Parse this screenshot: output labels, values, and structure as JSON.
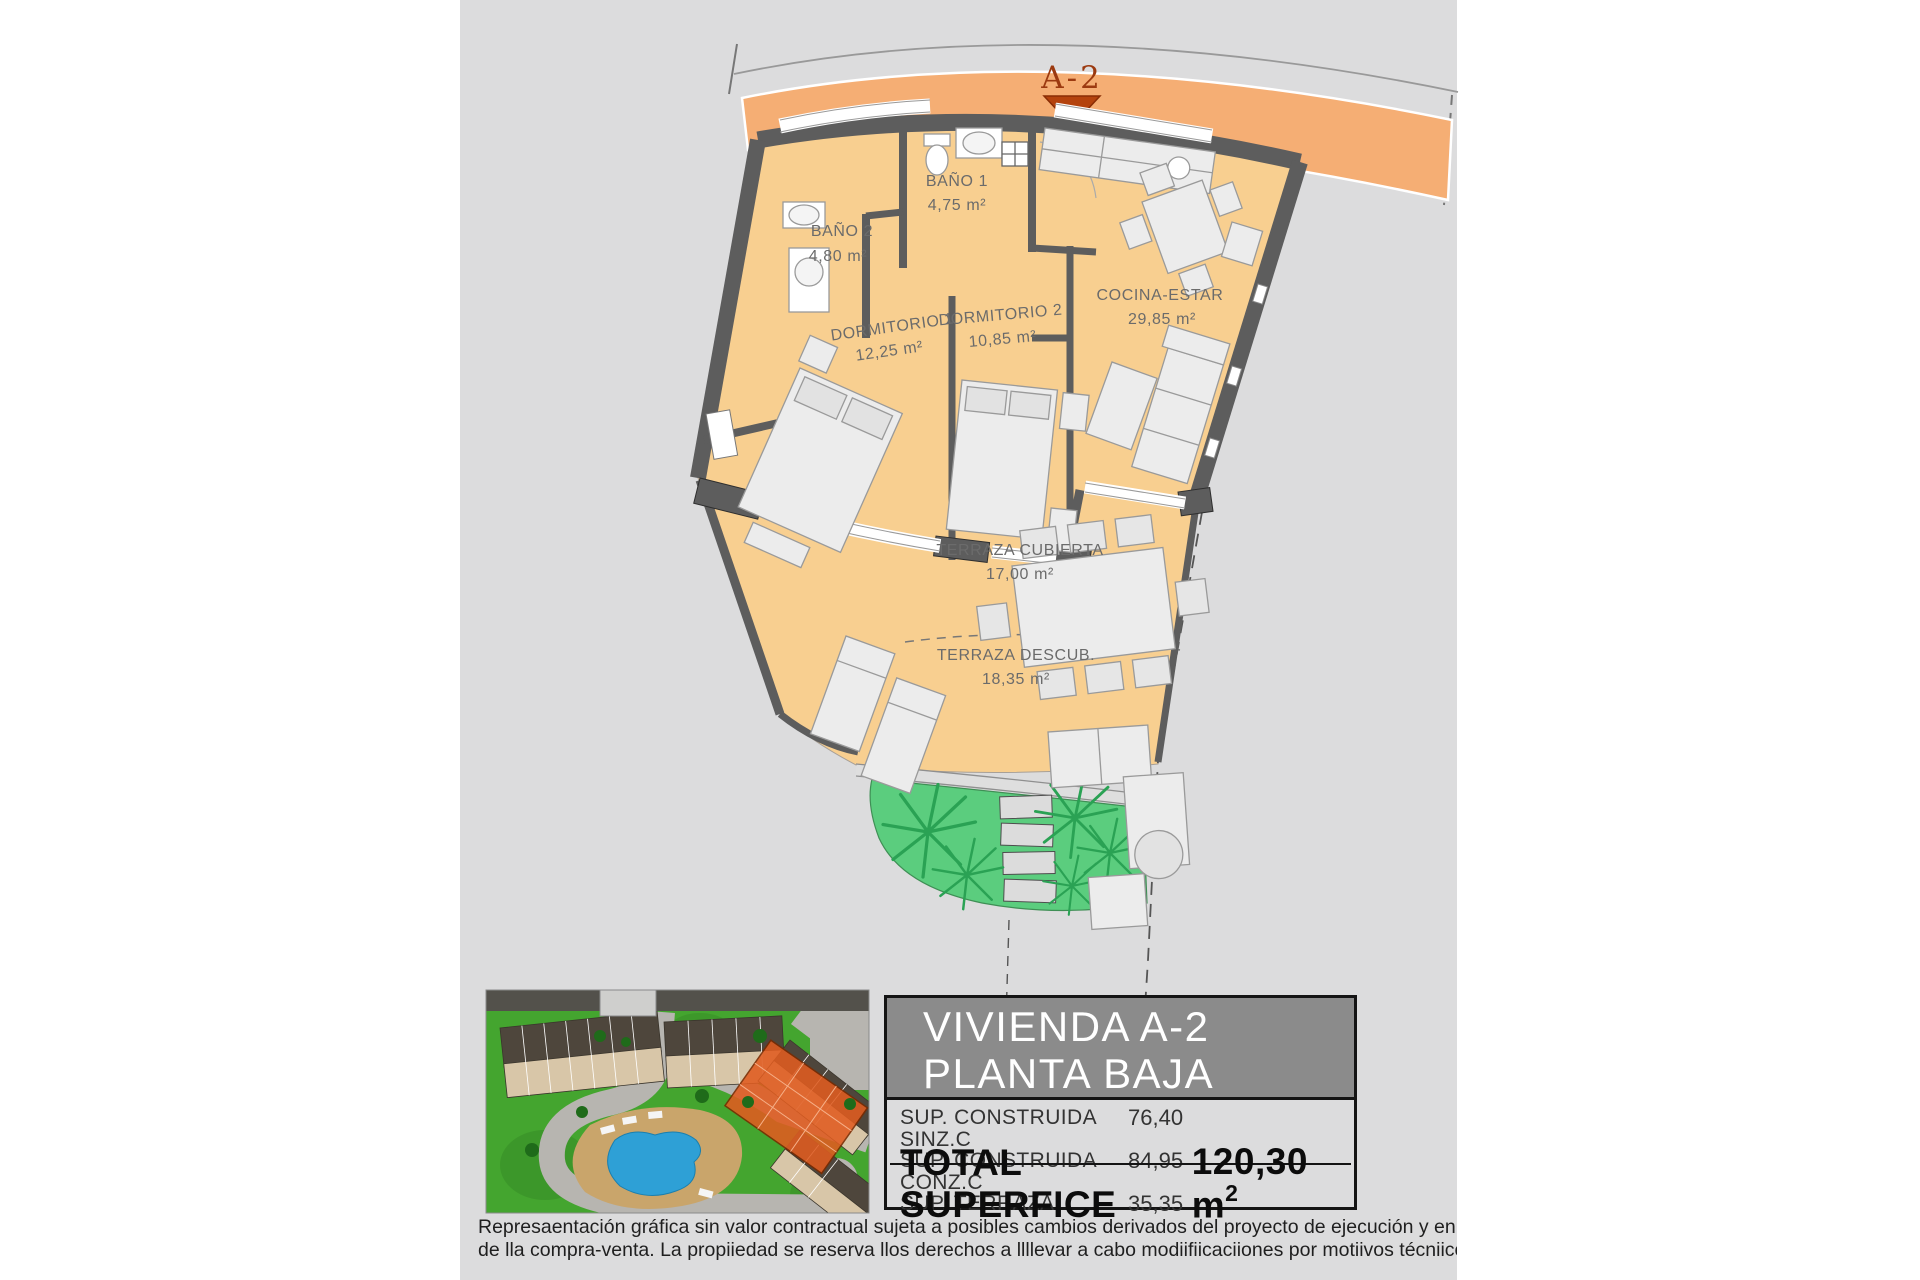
{
  "plan": {
    "marker": "A-2",
    "rooms": [
      {
        "name": "BAÑO 1",
        "area": "4,75 m²"
      },
      {
        "name": "BAÑO 2",
        "area": "4,80 m²"
      },
      {
        "name": "DORMITORIO 1",
        "area": "12,25 m²"
      },
      {
        "name": "DORMITORIO 2",
        "area": "10,85 m²"
      },
      {
        "name": "COCINA-ESTAR",
        "area": "29,85 m²"
      },
      {
        "name": "TERRAZA CUBIERTA",
        "area": "17,00 m²"
      },
      {
        "name": "TERRAZA DESCUB.",
        "area": "18,35 m²"
      }
    ]
  },
  "info_panel": {
    "title_line1": "VIVIENDA A-2",
    "title_line2": "PLANTA BAJA",
    "rows": [
      {
        "label": "SUP. CONSTRUIDA SINZ.C",
        "value": "76,40"
      },
      {
        "label": "SUP. CONSTRUIDA CONZ.C",
        "value": "84,95"
      },
      {
        "label": "SUP. TERRAZA",
        "value": "35,35"
      }
    ],
    "total_label": "TOTAL SUPERFICE",
    "total_value": "120,30 m",
    "total_value_sup": "2"
  },
  "disclaimer": {
    "line1": "Represaentación gráfica sin valor contractual sujeta a posibles cambios derivados del proyecto de ejecución y en cualquier caso será sustituido por el definitivo er",
    "line2": "de lla compra-venta. La propiiedad se reserva llos derechos a llllevar a cabo modiifiicaciiones por motiivos técniicos y cumplliiendo lla normatiiva viigente."
  },
  "colors": {
    "sheet_gray": "#dcdcdd",
    "street_band_orange": "#f5ae74",
    "floor_orange": "#f8cf90",
    "wall_gray": "#5d5d5d",
    "garden_green": "#5bcd7e",
    "frond_green": "#2aa254",
    "marker_red": "#9c3a10",
    "header_gray": "#8b8b8b",
    "highlight_orange": "#e05c20",
    "pool_blue": "#2ea0d6"
  }
}
